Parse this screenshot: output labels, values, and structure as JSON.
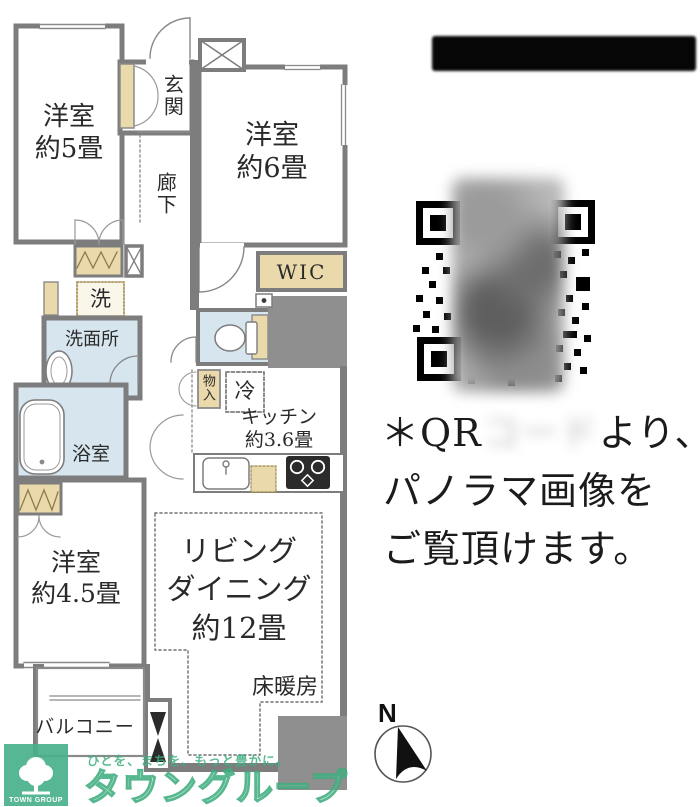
{
  "floorplan": {
    "bedroom5": {
      "label": "洋室\n約5畳"
    },
    "bedroom6": {
      "label": "洋室\n約6畳"
    },
    "bedroom45": {
      "label": "洋室\n約4.5畳"
    },
    "entrance": {
      "label": "玄関"
    },
    "hallway": {
      "label": "廊下"
    },
    "wic": {
      "label": "WIC"
    },
    "laundry": {
      "label": "洗"
    },
    "washroom": {
      "label": "洗面所"
    },
    "bathroom": {
      "label": "浴室"
    },
    "storage": {
      "label": "物入"
    },
    "refrigerator": {
      "label": "冷"
    },
    "kitchen": {
      "label": "キッチン\n約3.6畳"
    },
    "living_dining": {
      "label": "リビング\nダイニング\n約12畳"
    },
    "floor_heating": {
      "label": "床暖房"
    },
    "balcony": {
      "label": "バルコニー"
    }
  },
  "qr_note": {
    "line1_prefix": "＊QR",
    "line1_blurred": "コード",
    "line1_suffix": "より、",
    "line2": "パノラマ画像を",
    "line3": "ご覧頂けます。"
  },
  "compass": {
    "north": "N"
  },
  "watermark": {
    "tagline": "ひとを、まちを、もっと豊かに。",
    "brand": "タウングループ",
    "logo_caption": "TOWN GROUP",
    "brand_color": "#3fae7e"
  },
  "colors": {
    "wall_gray": "#7d7d7d",
    "closet_tan": "#e9d9ab",
    "wet_area_blue": "#d7e5ee",
    "block_gray": "#8f8f8f"
  }
}
